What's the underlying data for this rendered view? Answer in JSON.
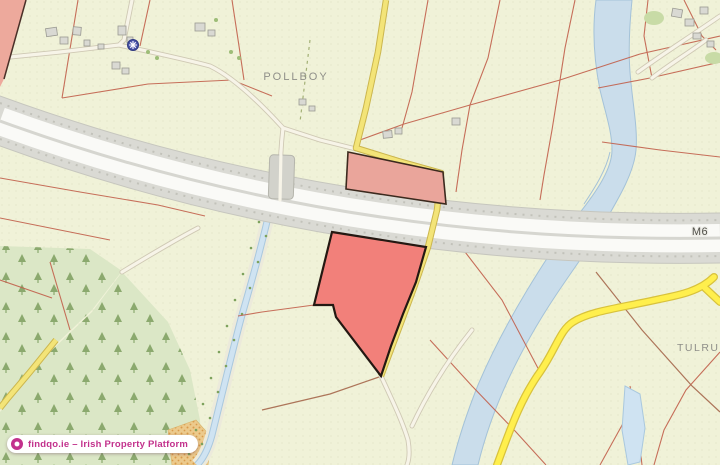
{
  "labels": {
    "townland_pollboy": "POLLBOY",
    "townland_tulrush": "TULRUSH",
    "motorway": "M6"
  },
  "watermark": {
    "text": "findqo.ie – Irish Property Platform",
    "logo_icon": "findqo-logo"
  },
  "icons": {
    "poi": "religious-site-icon"
  },
  "colors": {
    "background": "#f0f2d8",
    "boundary_line": "#c2604c",
    "selected_parcel": "#f2807a",
    "secondary_parcel": "#eaa59b",
    "corner_parcel": "#eda99c",
    "road_yellow": "#f3e478",
    "road_yellow_bright": "#ffef4d",
    "river": "#caddeb",
    "forest": "#dbe7c6",
    "motorway_gray": "#dadad4",
    "brand_pink": "#c2318c"
  }
}
